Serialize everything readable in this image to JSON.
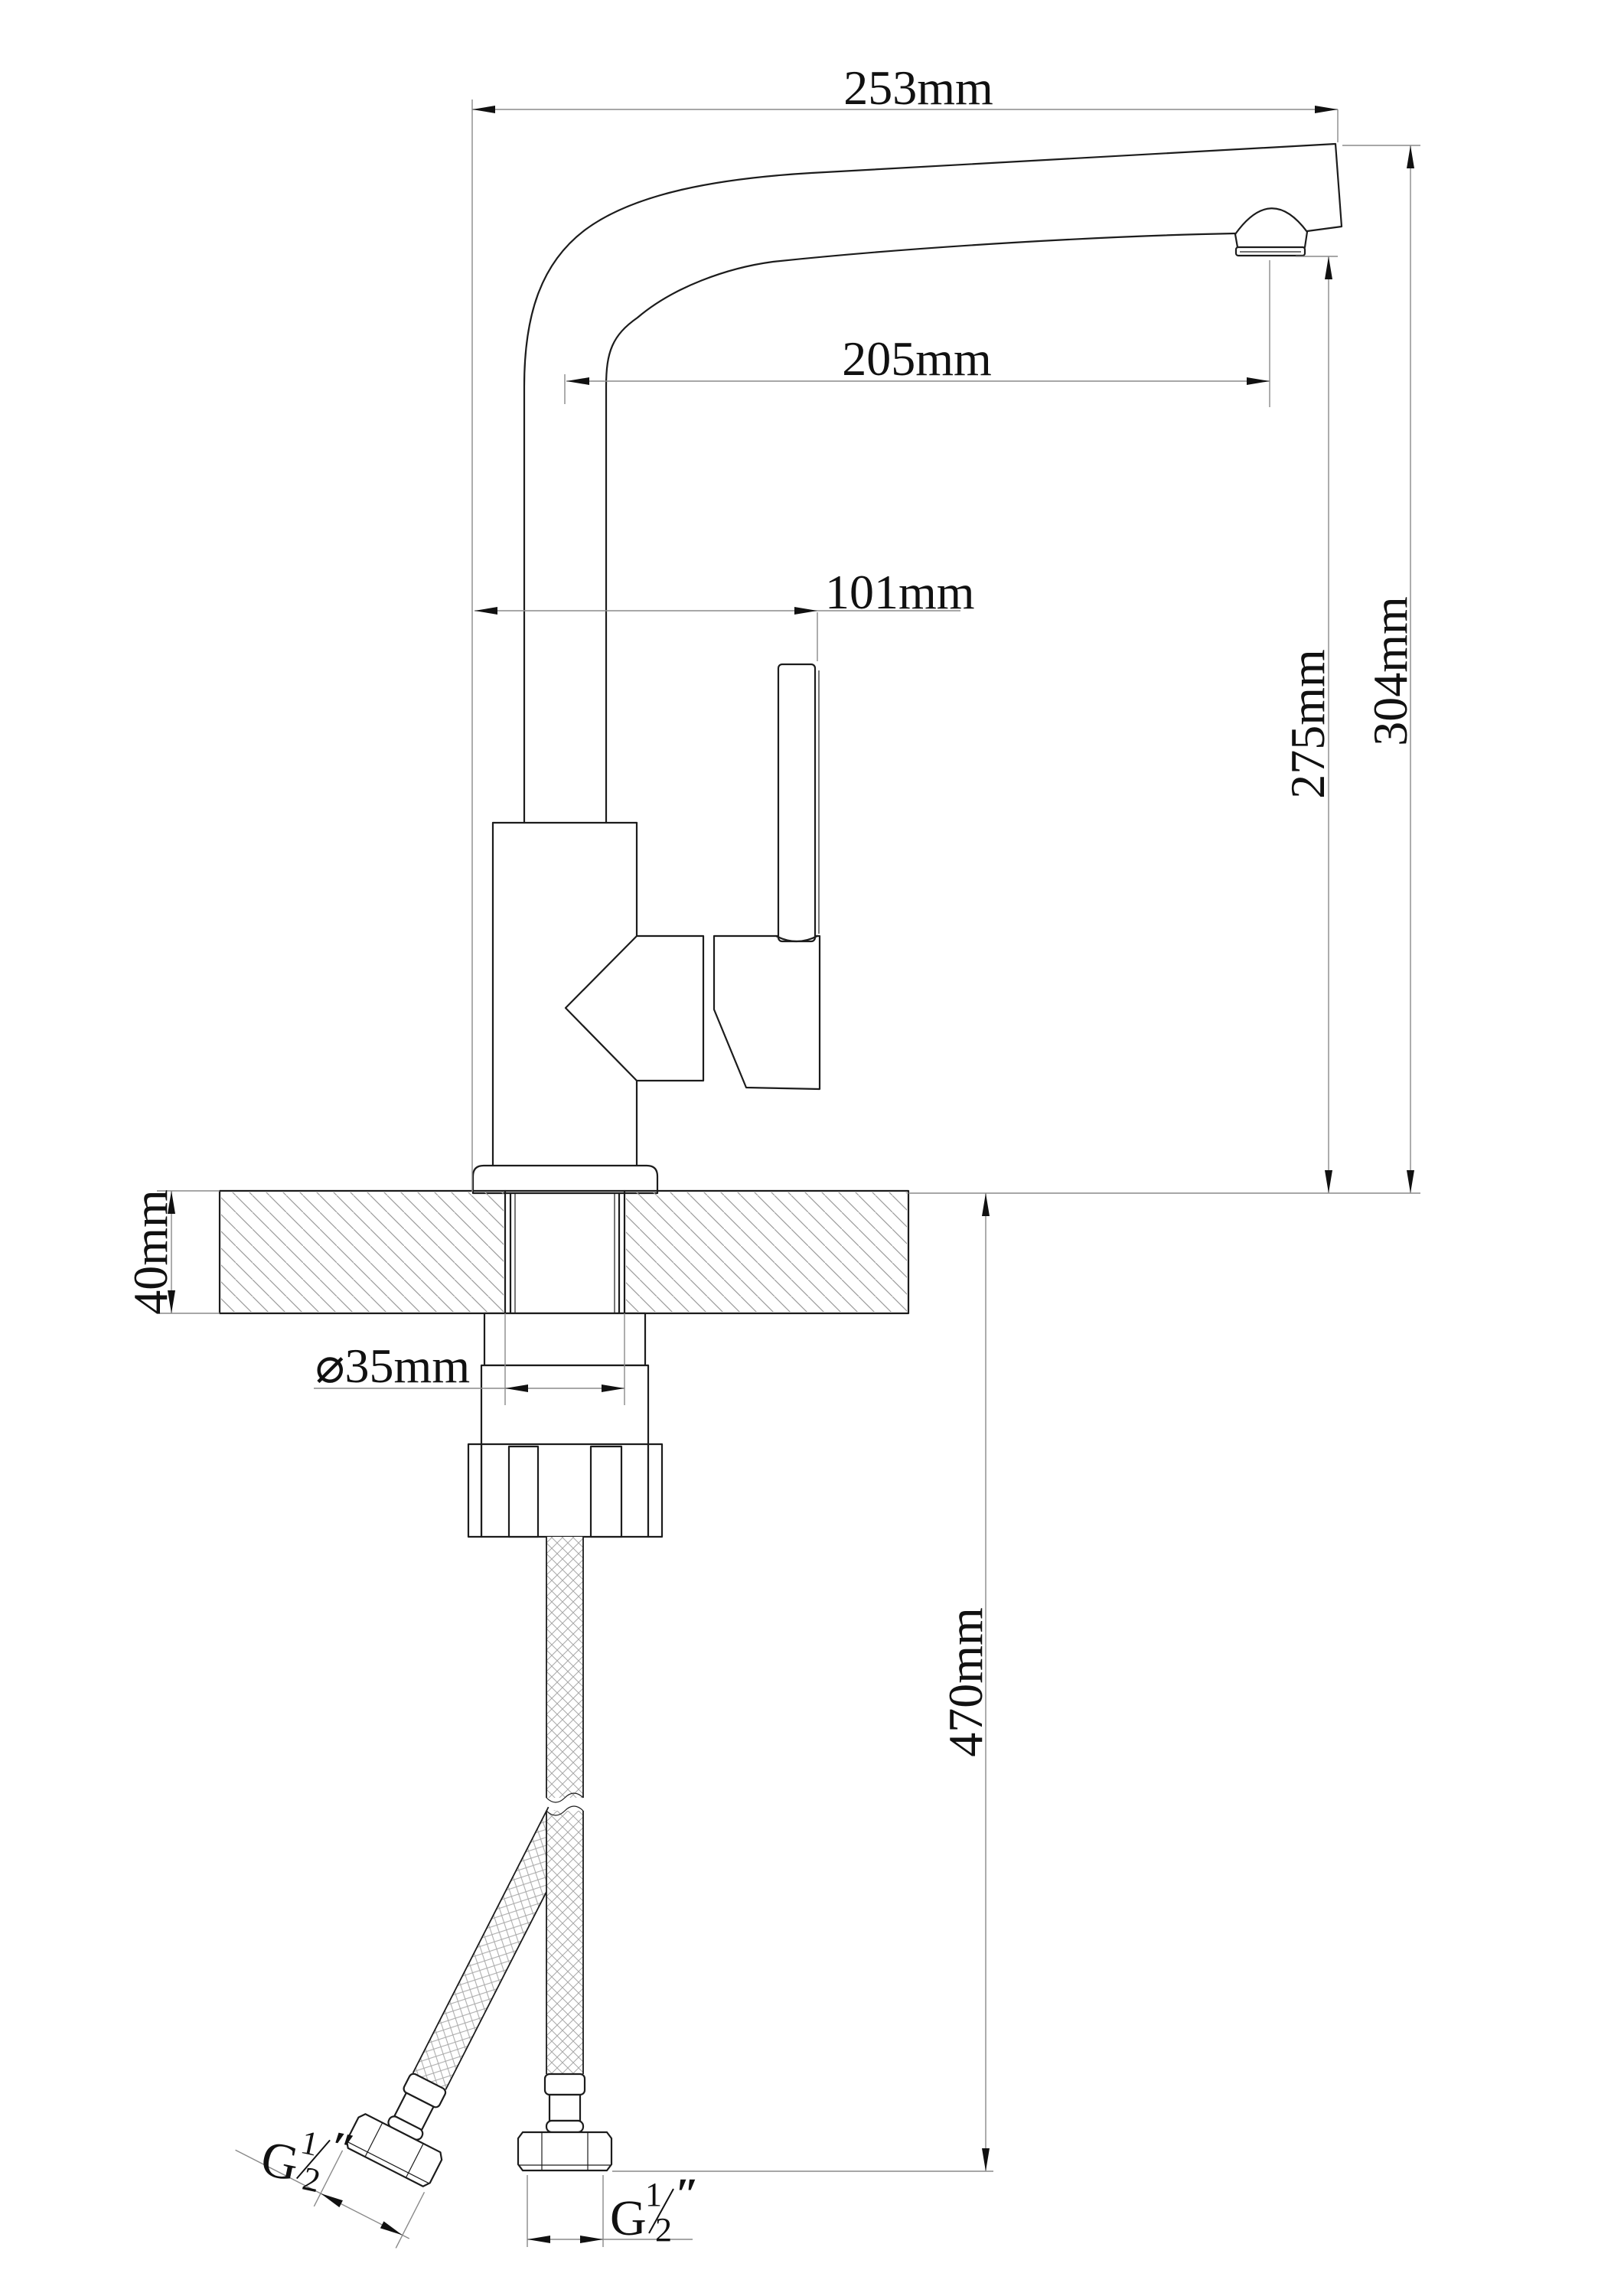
{
  "drawing": {
    "labels": {
      "spout_width": "253mm",
      "spout_reach": "205mm",
      "handle_offset": "101mm",
      "aerator_height": "275mm",
      "overall_height": "304mm",
      "deck_thickness": "40mm",
      "hole_diameter": "⌀35mm",
      "hose_length": "470mm"
    },
    "thread_labels": {
      "left": {
        "letter": "G",
        "numerator": "1",
        "denominator": "2",
        "unit": "″"
      },
      "bottom": {
        "letter": "G",
        "numerator": "1",
        "denominator": "2",
        "unit": "″"
      }
    },
    "colors": {
      "outline": "#1c1c1c",
      "dimension_line": "#8a8a8a",
      "hatch": "#9a9a9a",
      "text": "#111111",
      "background": "#ffffff"
    }
  }
}
